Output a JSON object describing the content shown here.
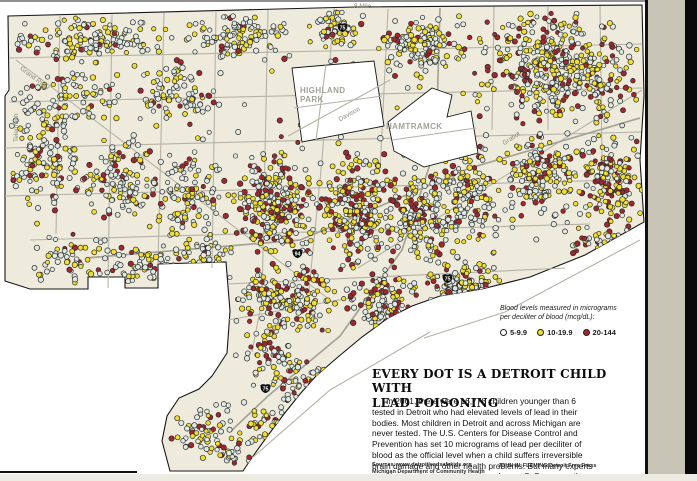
{
  "window": {
    "top_line_color": "#8f8f8f",
    "map_frame_color": "#101010",
    "side_strip_color": "#c8c4b5",
    "right_bar_color": "#0a0a0a",
    "bottom_strip_color": "#edebe2"
  },
  "map": {
    "land_color": "#efebdc",
    "background_color": "#ffffff",
    "border_color": "#161616",
    "road_color": "#b4b2a5",
    "freeway_color": "#a5a396",
    "label_color": "#8a887c",
    "city_label_color": "#a2a196",
    "labels": {
      "eight_mile": "8 Mile",
      "telegraph": "Telegraph",
      "grand_river": "Grand River",
      "davison": "Davison",
      "gratiot": "Gratiot",
      "highland_park": "HIGHLAND\nPARK",
      "hamtramck": "HAMTRAMCK"
    },
    "shields": [
      {
        "label": "75",
        "x": 336,
        "y": 21
      },
      {
        "label": "94",
        "x": 291,
        "y": 247
      },
      {
        "label": "75",
        "x": 441,
        "y": 272
      },
      {
        "label": "75",
        "x": 259,
        "y": 382
      }
    ],
    "dot_colors": {
      "low": "#dfe9e3",
      "mid": "#f0df2e",
      "high": "#a1262e",
      "outline": "#2a2a2a"
    },
    "dot_clusters": [
      [
        10,
        14,
        170,
        52,
        150,
        0.62,
        0.3
      ],
      [
        8,
        70,
        120,
        58,
        95,
        0.6,
        0.3
      ],
      [
        130,
        60,
        92,
        68,
        85,
        0.55,
        0.35
      ],
      [
        180,
        10,
        118,
        52,
        110,
        0.6,
        0.32
      ],
      [
        298,
        8,
        72,
        44,
        55,
        0.55,
        0.35
      ],
      [
        372,
        10,
        98,
        68,
        130,
        0.5,
        0.38
      ],
      [
        470,
        8,
        172,
        122,
        430,
        0.38,
        0.38
      ],
      [
        578,
        132,
        64,
        100,
        155,
        0.34,
        0.34
      ],
      [
        498,
        130,
        85,
        100,
        165,
        0.45,
        0.35
      ],
      [
        430,
        140,
        72,
        108,
        150,
        0.45,
        0.35
      ],
      [
        4,
        100,
        80,
        128,
        115,
        0.6,
        0.28
      ],
      [
        82,
        130,
        80,
        100,
        115,
        0.55,
        0.32
      ],
      [
        150,
        142,
        80,
        98,
        100,
        0.55,
        0.33
      ],
      [
        30,
        232,
        90,
        54,
        55,
        0.6,
        0.3
      ],
      [
        100,
        244,
        92,
        42,
        65,
        0.55,
        0.33
      ],
      [
        228,
        150,
        92,
        112,
        235,
        0.35,
        0.38
      ],
      [
        312,
        152,
        92,
        118,
        245,
        0.35,
        0.38
      ],
      [
        392,
        172,
        58,
        96,
        140,
        0.42,
        0.37
      ],
      [
        230,
        262,
        118,
        78,
        185,
        0.4,
        0.37
      ],
      [
        340,
        268,
        88,
        68,
        120,
        0.45,
        0.35
      ],
      [
        420,
        248,
        88,
        68,
        90,
        0.5,
        0.33
      ],
      [
        180,
        228,
        56,
        56,
        55,
        0.55,
        0.32
      ],
      [
        230,
        330,
        80,
        48,
        45,
        0.52,
        0.33
      ],
      [
        250,
        350,
        95,
        58,
        60,
        0.5,
        0.33
      ],
      [
        225,
        392,
        80,
        58,
        50,
        0.5,
        0.32
      ],
      [
        168,
        402,
        75,
        66,
        55,
        0.55,
        0.3
      ],
      [
        435,
        272,
        70,
        26,
        32,
        0.5,
        0.35
      ],
      [
        8,
        12,
        630,
        290,
        130,
        0.62,
        0.28
      ],
      [
        200,
        438,
        58,
        32,
        26,
        0.5,
        0.3
      ],
      [
        560,
        225,
        80,
        30,
        40,
        0.45,
        0.33
      ]
    ]
  },
  "legend": {
    "heading": "Blood levels measured in micrograms\nper deciliter of blood (mcg/dL):",
    "items": [
      {
        "label": "5-9.9",
        "color": "#ffffff"
      },
      {
        "label": "10-19.9",
        "color": "#f0df2e"
      },
      {
        "label": "20-144",
        "color": "#a1262e"
      }
    ]
  },
  "headline": "EVERY DOT IS A DETROIT CHILD WITH\nLEAD POISONING",
  "body_text": "In 2001, there were 16,778 children younger than 6 tested in Detroit who had elevated levels of lead in their bodies. Most children in Detroit and across Michigan are never tested. The U.S. Centers for Disease Control and Prevention has set 10 micrograms of lead per deciliter of blood as the official level when a child suffers irreversible brain damage and other health problems. But many experts say damage happens at levels as low as 5. Some say there is no safe level of lead.",
  "credits": {
    "sources": "Sources: www.detroitleadsafekids.org\nMichigan Department of Community Health",
    "byline": "JOHN W. FLEMING/Detroit Free Press"
  }
}
